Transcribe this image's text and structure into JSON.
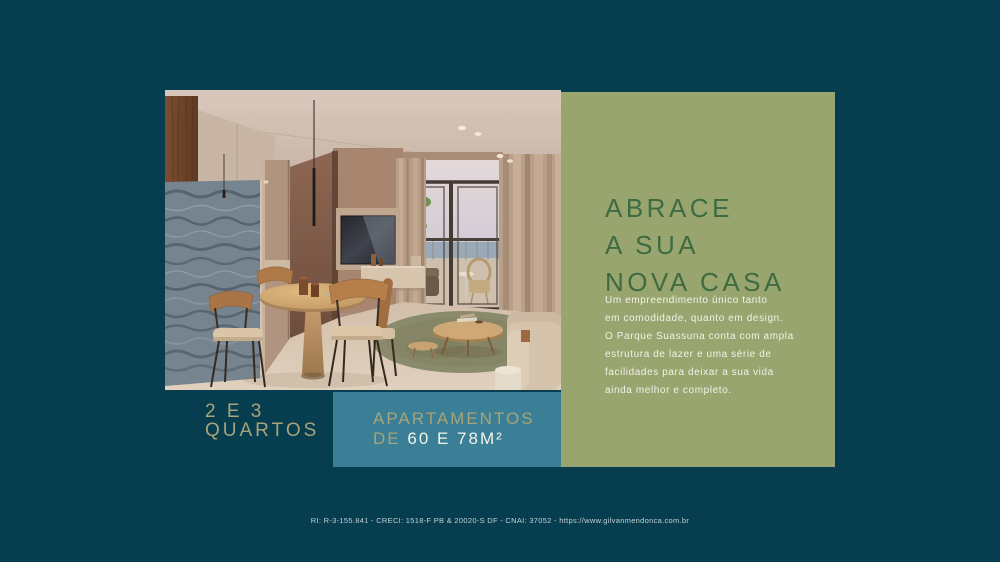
{
  "colors": {
    "background": "#063E50",
    "panel_green": "#99A56E",
    "heading_green": "#3E6B41",
    "badge_teal": "#3A7F95",
    "accent_gold": "#A8A378",
    "text_white": "#F2F1E9",
    "footer_text": "#C2CFD3"
  },
  "panel": {
    "headline_lines": [
      "ABRACE",
      "A SUA",
      "NOVA CASA"
    ],
    "description": "Um empreendimento único tanto\nem comodidade, quanto em design.\nO Parque Suassuna conta com ampla\nestrutura de lazer e uma série de\nfacilidades para deixar a sua vida\nainda melhor e completo."
  },
  "badges": {
    "bedrooms_line1": "2 E 3",
    "bedrooms_line2": "QUARTOS",
    "apartments_line1": "APARTAMENTOS",
    "apartments_line2_prefix": "DE",
    "apartments_line2_value": "60 E 78M²"
  },
  "footer": {
    "legal": "RI: R-3-155.841 - CRECI: 1518-F PB & 20020-S DF - CNAI: 37052 - https://www.gilvanmendonca.com.br"
  }
}
